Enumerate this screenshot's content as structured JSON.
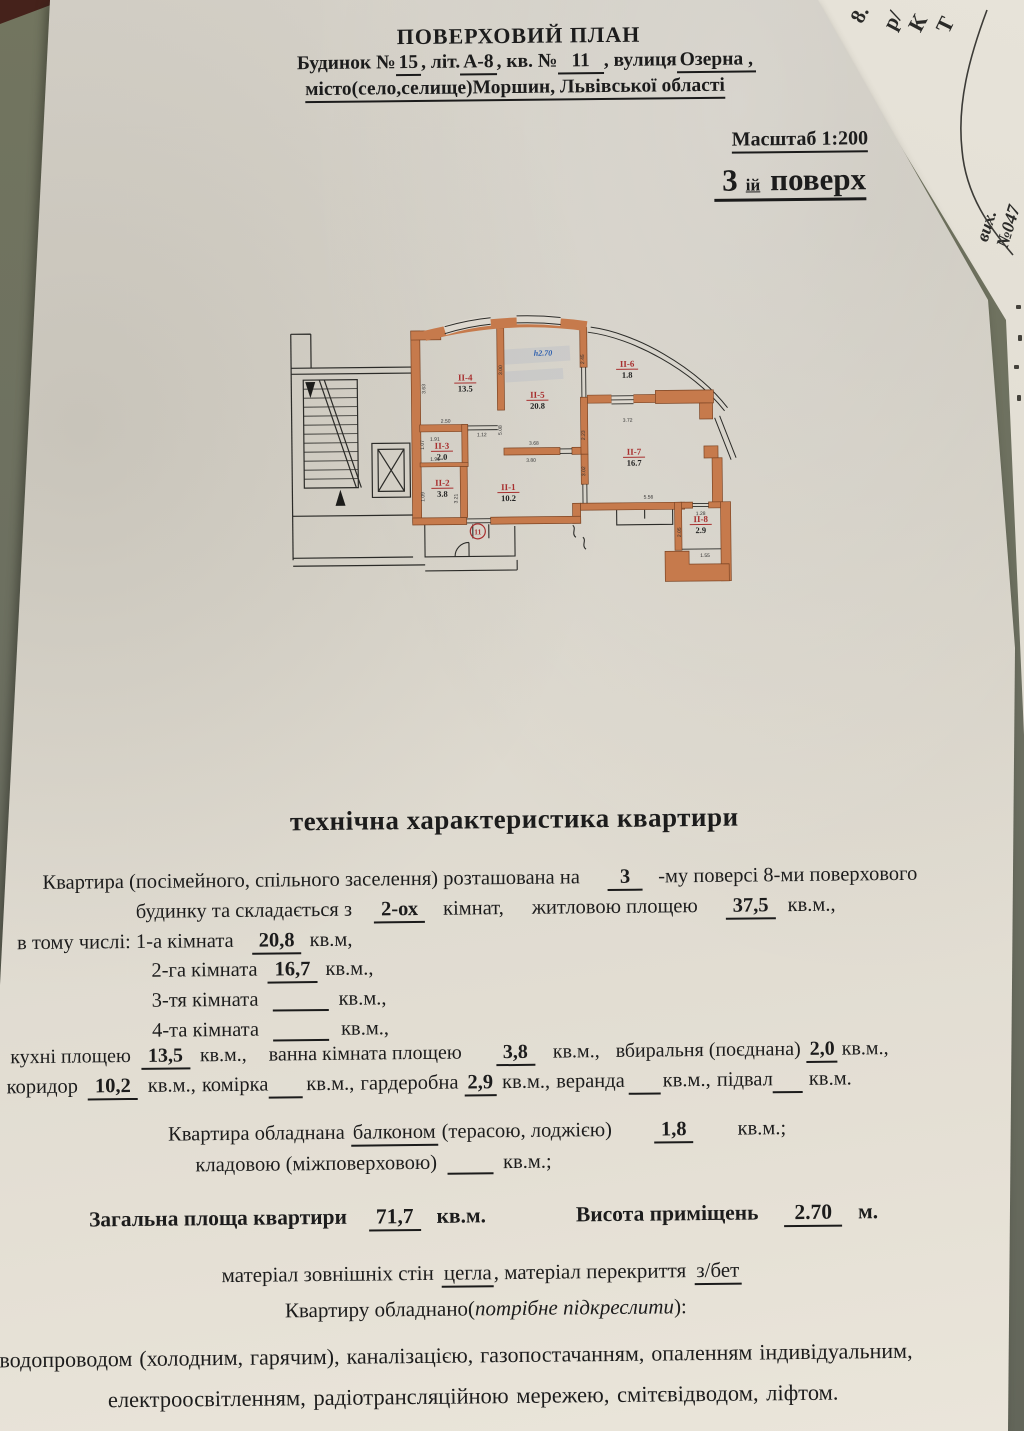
{
  "under_paper": {
    "letters": [
      "8.",
      "р/",
      "К",
      "Т"
    ],
    "note": "вих. №047"
  },
  "header": {
    "title": "ПОВЕРХОВИЙ ПЛАН",
    "l2": {
      "a": "Будинок № ",
      "b": "15",
      "c": ", літ.",
      "d": "А-8",
      "e": ", кв. № ",
      "f": "11",
      "g": ", вулиця ",
      "h": "Озерна ,"
    },
    "l3": {
      "a": "місто",
      "b": " (село,селище) ",
      "c": "Моршин, Львівської області"
    },
    "scale": "Масштаб 1:200",
    "floor_num": "3",
    "floor_sup": "ій",
    "floor_word": "поверх"
  },
  "plan": {
    "rooms": [
      {
        "id": "ІІ-4",
        "area": "13.5"
      },
      {
        "id": "ІІ-5",
        "area": "20.8"
      },
      {
        "id": "ІІ-6",
        "area": "1.8"
      },
      {
        "id": "ІІ-7",
        "area": "16.7"
      },
      {
        "id": "ІІ-3",
        "area": "2.0"
      },
      {
        "id": "ІІ-2",
        "area": "3.8"
      },
      {
        "id": "ІІ-1",
        "area": "10.2"
      },
      {
        "id": "ІІ-8",
        "area": "2.9"
      }
    ],
    "height_note": "h2.70",
    "unit_number": "11",
    "dims": [
      "3.63",
      "3.00",
      "2.45",
      "5.08",
      "2.50",
      "1.12",
      "1.91",
      "1.91",
      "1.07",
      "1.09",
      "3.21",
      "3.68",
      "3.80",
      "2.23",
      "3.02",
      "3.72",
      "5.56",
      "1.28",
      "1.55",
      "2.05"
    ]
  },
  "tech": {
    "title": "технічна характеристика квартири",
    "l1": {
      "a": "Квартира (посімейного, спільного заселення) розташована на",
      "v": "3",
      "b": "-му  поверсі 8-ми поверхового"
    },
    "l2": {
      "a": "будинку та складається з",
      "v": "2-ох",
      "b": "кімнат,",
      "c": "житловою площею",
      "v2": "37,5",
      "d": "кв.м.,"
    },
    "l3": {
      "a": "в тому числі: 1-а кімната",
      "v": "20,8",
      "b": "кв.м,"
    },
    "l4": {
      "a": "2-га кімната",
      "v": "16,7",
      "b": "кв.м.,"
    },
    "l5": {
      "a": "3-тя кімната",
      "b": "кв.м.,"
    },
    "l6": {
      "a": "4-та кімната",
      "b": "кв.м.,"
    },
    "l7": {
      "a": "кухні площею",
      "v": "13,5",
      "b": "кв.м.,",
      "c": "ванна кімната площею",
      "v2": "3,8",
      "d": "кв.м.,",
      "e": "вбиральня (поєднана)",
      "v3": "2,0",
      "f": "кв.м.,"
    },
    "l8": {
      "a": "коридор",
      "v": "10,2",
      "b": "кв.м., комірка",
      "c": "кв.м., гардеробна",
      "v2": "2,9",
      "d": "кв.м., веранда",
      "e": "кв.м., підвал",
      "f": "кв.м."
    },
    "l9": {
      "a": "Квартира обладнана",
      "u": "балконом",
      "b": "(терасою, лоджією)",
      "v": "1,8",
      "c": "кв.м.;"
    },
    "l10": {
      "a": "кладовою (міжповерховою)",
      "b": "кв.м.;"
    },
    "l11": {
      "a": "Загальна площа квартири",
      "v": "71,7",
      "b": "кв.м.",
      "c": "Висота приміщень",
      "v2": "2.70",
      "d": "м."
    },
    "l12": {
      "a": "матеріал зовнішніх стін",
      "u": "цегла",
      "b": ", матеріал перекриття",
      "u2": "з/бет"
    },
    "l13": {
      "a": "Квартиру обладнано(",
      "i": "потрібне підкреслити",
      "b": "):"
    },
    "l14": "водопроводом (холодним, гарячим), каналізацією, газопостачанням, опаленням  індивідуальним,",
    "l15": "електроосвітленням, радіотрансляційною мережею, смітєвідводом, ліфтом."
  }
}
